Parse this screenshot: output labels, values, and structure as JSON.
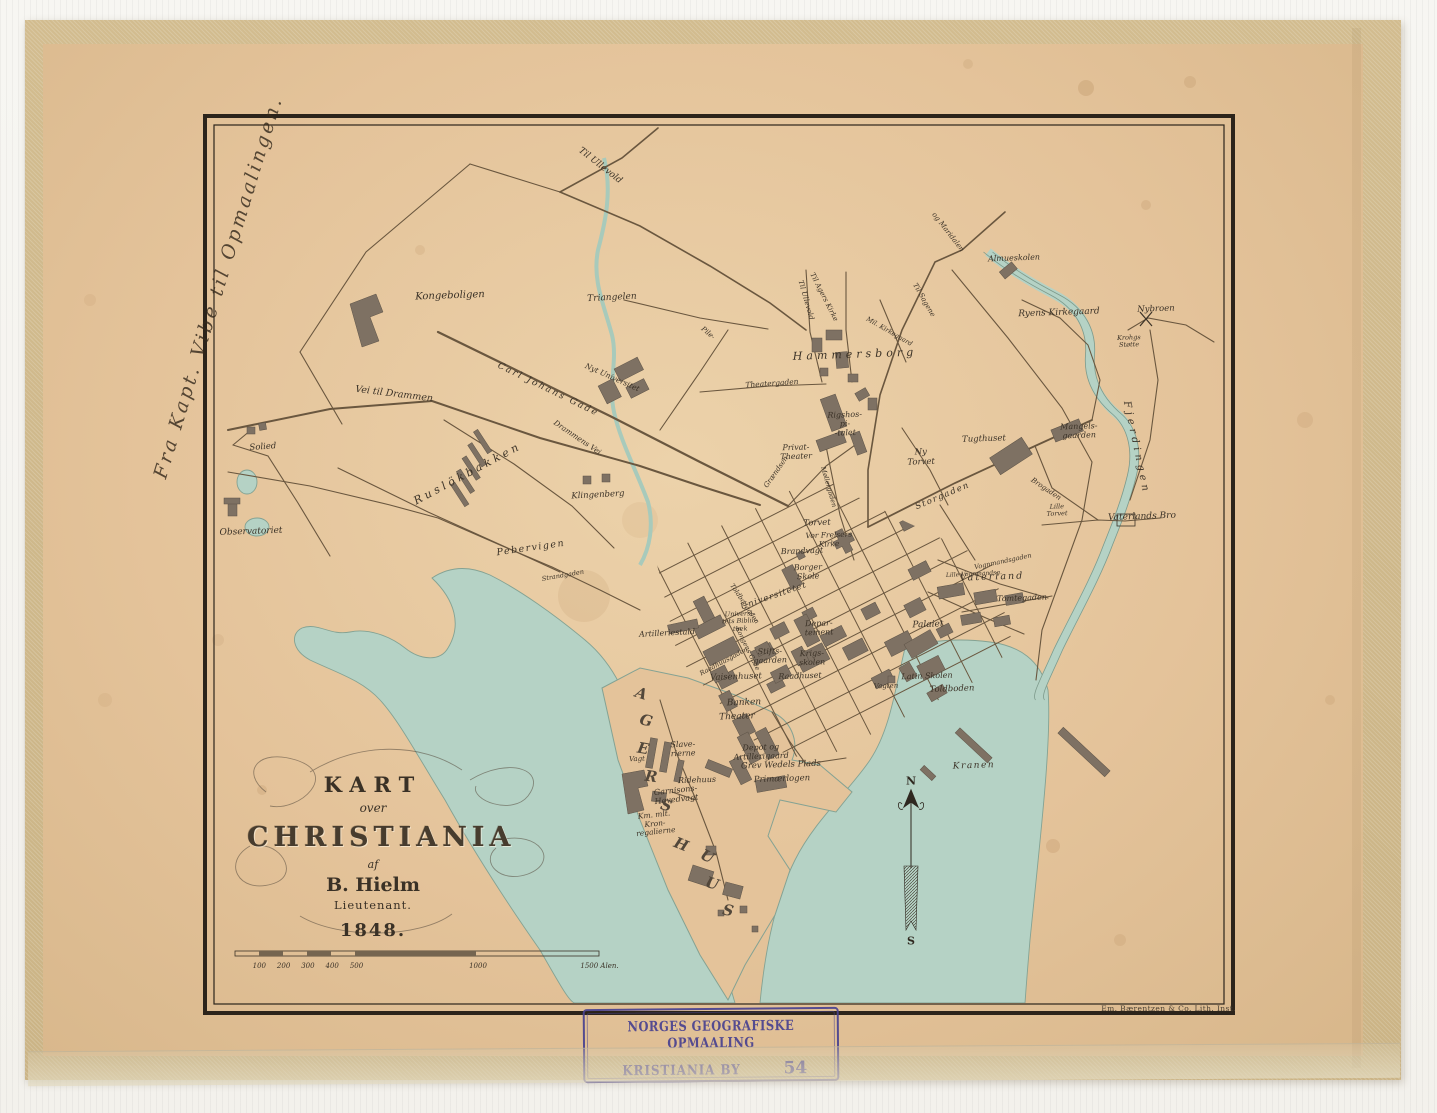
{
  "map": {
    "title_block": {
      "l1": "KART",
      "l2": "over",
      "l3": "CHRISTIANIA",
      "l4": "af",
      "l5": "B. Hielm",
      "l6": "Lieutenant.",
      "l7": "1848."
    },
    "compass": {
      "north": "N",
      "south": "S"
    },
    "scale_bar": {
      "ticks": [
        100,
        200,
        300,
        400,
        500,
        1000,
        1500
      ],
      "unit": "Alen."
    },
    "imprint": "Em. Bærentzen & Co. Lith. Inst.",
    "handwritten_note": "Fra Kapt. Vibe til Opmaalingen.",
    "labels": [
      {
        "t": "Til Ullevold",
        "x": 600,
        "y": 166,
        "r": 38,
        "s": 9
      },
      {
        "t": "Kongeboligen",
        "x": 450,
        "y": 296,
        "r": -2,
        "s": 10
      },
      {
        "t": "Triangelen",
        "x": 612,
        "y": 298,
        "r": -3,
        "s": 9
      },
      {
        "t": "Vei til Drammen",
        "x": 394,
        "y": 395,
        "r": 7,
        "s": 9.5
      },
      {
        "t": "Carl Johans Gade",
        "x": 548,
        "y": 390,
        "r": 26,
        "s": 9,
        "ls": 2
      },
      {
        "t": "Nyt Universitet",
        "x": 612,
        "y": 378,
        "r": 24,
        "s": 7.5
      },
      {
        "t": "Solied",
        "x": 263,
        "y": 448,
        "r": -4,
        "s": 8.5
      },
      {
        "t": "Observatoriet",
        "x": 251,
        "y": 532,
        "r": -2,
        "s": 9
      },
      {
        "t": "Ruslökbakken",
        "x": 468,
        "y": 474,
        "r": -28,
        "s": 11,
        "ls": 3.5
      },
      {
        "t": "Klingenberg",
        "x": 598,
        "y": 496,
        "r": -3,
        "s": 8.5
      },
      {
        "t": "Pebervigen",
        "x": 531,
        "y": 549,
        "r": -8,
        "s": 9.5,
        "ls": 1.5
      },
      {
        "t": "Strandgaden",
        "x": 563,
        "y": 576,
        "r": -10,
        "s": 6.5
      },
      {
        "t": "Drammens Vei",
        "x": 577,
        "y": 438,
        "r": 34,
        "s": 7.5
      },
      {
        "t": "Til Agers Kirke",
        "x": 824,
        "y": 297,
        "r": 63,
        "s": 7
      },
      {
        "t": "Til Ullevold",
        "x": 806,
        "y": 300,
        "r": 74,
        "s": 7
      },
      {
        "t": "Til Sagene",
        "x": 924,
        "y": 300,
        "r": 60,
        "s": 7
      },
      {
        "t": "og Maridalen",
        "x": 948,
        "y": 232,
        "r": 52,
        "s": 7
      },
      {
        "t": "Hammersborg",
        "x": 855,
        "y": 355,
        "r": -2,
        "s": 11,
        "ls": 4
      },
      {
        "t": "Mil. Kirkegaard",
        "x": 889,
        "y": 332,
        "r": 30,
        "s": 6.5
      },
      {
        "t": "Almueskolen",
        "x": 1014,
        "y": 258,
        "r": -2,
        "s": 8
      },
      {
        "t": "Ryens Kirkegaard",
        "x": 1059,
        "y": 313,
        "r": -2,
        "s": 9
      },
      {
        "t": "Nybroen",
        "x": 1156,
        "y": 310,
        "r": -2,
        "s": 8.5
      },
      {
        "t": "Krohgs\nStøtte",
        "x": 1129,
        "y": 342,
        "r": -2,
        "s": 6.5
      },
      {
        "t": "Mangels-\ngaarden",
        "x": 1079,
        "y": 431,
        "r": -2,
        "s": 8
      },
      {
        "t": "Tugthuset",
        "x": 984,
        "y": 440,
        "r": -2,
        "s": 8.5
      },
      {
        "t": "Ny\nTorvet",
        "x": 921,
        "y": 458,
        "r": -2,
        "s": 8.5
      },
      {
        "t": "Rigshos-\npi-\n-talet",
        "x": 845,
        "y": 424,
        "r": -2,
        "s": 8
      },
      {
        "t": "Privat-\nTheater",
        "x": 796,
        "y": 452,
        "r": -2,
        "s": 8
      },
      {
        "t": "Theatergaden",
        "x": 772,
        "y": 384,
        "r": -4,
        "s": 7.5
      },
      {
        "t": "Storgaden",
        "x": 943,
        "y": 497,
        "r": -23,
        "s": 8.5,
        "ls": 1.5
      },
      {
        "t": "Fjerdingen",
        "x": 1136,
        "y": 448,
        "r": 78,
        "s": 10,
        "ls": 4
      },
      {
        "t": "Vaterlands Bro",
        "x": 1142,
        "y": 517,
        "r": -2,
        "s": 9
      },
      {
        "t": "Lille\nTorvet",
        "x": 1057,
        "y": 511,
        "r": -2,
        "s": 6.5
      },
      {
        "t": "Vaterland",
        "x": 992,
        "y": 578,
        "r": -2,
        "s": 9.5,
        "ls": 2
      },
      {
        "t": "Tomtegaden",
        "x": 1022,
        "y": 598,
        "r": -2,
        "s": 8
      },
      {
        "t": "Vognmandsgaden",
        "x": 1003,
        "y": 562,
        "r": -12,
        "s": 6.5
      },
      {
        "t": "Lille Vognmandsg.",
        "x": 974,
        "y": 575,
        "r": -3,
        "s": 6
      },
      {
        "t": "Torvet",
        "x": 817,
        "y": 524,
        "r": -2,
        "s": 8.5
      },
      {
        "t": "Vor Frelsers\nKirke",
        "x": 829,
        "y": 540,
        "r": -2,
        "s": 7.5
      },
      {
        "t": "Brandvagt",
        "x": 802,
        "y": 551,
        "r": -2,
        "s": 8
      },
      {
        "t": "Borger\nSkole",
        "x": 808,
        "y": 572,
        "r": -2,
        "s": 8
      },
      {
        "t": "Universitetet",
        "x": 774,
        "y": 597,
        "r": -19,
        "s": 8.5,
        "ls": 1
      },
      {
        "t": "Universi-\ntets Biblio-\nthek",
        "x": 740,
        "y": 622,
        "r": -2,
        "s": 6.5
      },
      {
        "t": "Artilleriestald",
        "x": 667,
        "y": 633,
        "r": -3,
        "s": 8
      },
      {
        "t": "Depar-\ntement",
        "x": 819,
        "y": 628,
        "r": -2,
        "s": 8
      },
      {
        "t": "Stifts-\ngaarden",
        "x": 770,
        "y": 656,
        "r": -2,
        "s": 8
      },
      {
        "t": "Krigs-\nskolen",
        "x": 812,
        "y": 658,
        "r": -2,
        "s": 8
      },
      {
        "t": "Raadhuset",
        "x": 800,
        "y": 676,
        "r": -2,
        "s": 8
      },
      {
        "t": "Vaisenhuset",
        "x": 736,
        "y": 678,
        "r": -2,
        "s": 8.5
      },
      {
        "t": "Palaiet",
        "x": 928,
        "y": 625,
        "r": -2,
        "s": 9
      },
      {
        "t": "Latin Skolen",
        "x": 927,
        "y": 676,
        "r": -2,
        "s": 8
      },
      {
        "t": "Toldboden",
        "x": 952,
        "y": 690,
        "r": -2,
        "s": 8.5
      },
      {
        "t": "Vagten",
        "x": 886,
        "y": 686,
        "r": -2,
        "s": 7
      },
      {
        "t": "Banken",
        "x": 744,
        "y": 703,
        "r": -2,
        "s": 9
      },
      {
        "t": "Theater",
        "x": 737,
        "y": 717,
        "r": -2,
        "s": 9
      },
      {
        "t": "Slave-\nrierne",
        "x": 683,
        "y": 749,
        "r": -2,
        "s": 8
      },
      {
        "t": "Vagt",
        "x": 637,
        "y": 759,
        "r": -2,
        "s": 7
      },
      {
        "t": "Depot og\nArtillerigaard",
        "x": 761,
        "y": 752,
        "r": -2,
        "s": 8
      },
      {
        "t": "Grev Wedels Plads",
        "x": 781,
        "y": 766,
        "r": -2,
        "s": 8.5
      },
      {
        "t": "Primærlogen",
        "x": 782,
        "y": 780,
        "r": -2,
        "s": 8.5
      },
      {
        "t": "Ridehuus",
        "x": 697,
        "y": 780,
        "r": -2,
        "s": 8
      },
      {
        "t": "Garnisons-\nHovedvagt",
        "x": 676,
        "y": 795,
        "r": -6,
        "s": 8
      },
      {
        "t": "Km. mlt.\nKron-\nregalierne",
        "x": 655,
        "y": 824,
        "r": -6,
        "s": 7.5
      },
      {
        "t": "Kranen",
        "x": 974,
        "y": 766,
        "r": -2,
        "s": 9,
        "ls": 1.5
      },
      {
        "t": "Grændsen",
        "x": 776,
        "y": 472,
        "r": -55,
        "s": 7
      },
      {
        "t": "Møllergaden",
        "x": 828,
        "y": 487,
        "r": 74,
        "s": 6.5
      },
      {
        "t": "Pile-",
        "x": 708,
        "y": 333,
        "r": 40,
        "s": 7
      },
      {
        "t": "Kongens Gade",
        "x": 747,
        "y": 649,
        "r": 64,
        "s": 6.5
      },
      {
        "t": "Toldbodgaden",
        "x": 744,
        "y": 604,
        "r": 56,
        "s": 6.5
      },
      {
        "t": "Raadhuusgaden",
        "x": 724,
        "y": 662,
        "r": -28,
        "s": 6.5
      },
      {
        "t": "Brogaden",
        "x": 1046,
        "y": 489,
        "r": 34,
        "s": 7
      },
      {
        "t": "A",
        "x": 641,
        "y": 694,
        "r": 18,
        "s": 15,
        "c": "big"
      },
      {
        "t": "G",
        "x": 646,
        "y": 721,
        "r": 14,
        "s": 15,
        "c": "big"
      },
      {
        "t": "E",
        "x": 643,
        "y": 749,
        "r": 10,
        "s": 15,
        "c": "big"
      },
      {
        "t": "R",
        "x": 651,
        "y": 777,
        "r": 8,
        "s": 15,
        "c": "big"
      },
      {
        "t": "S",
        "x": 666,
        "y": 806,
        "r": 16,
        "s": 15,
        "c": "big"
      },
      {
        "t": "H",
        "x": 681,
        "y": 845,
        "r": 22,
        "s": 15,
        "c": "big"
      },
      {
        "t": "U",
        "x": 707,
        "y": 857,
        "r": 26,
        "s": 15,
        "c": "big"
      },
      {
        "t": "U",
        "x": 712,
        "y": 884,
        "r": 18,
        "s": 15,
        "c": "big"
      },
      {
        "t": "S",
        "x": 728,
        "y": 911,
        "r": 12,
        "s": 15,
        "c": "big"
      }
    ]
  },
  "stamp": {
    "line1": "NORGES GEOGRAFISKE OPMAALING",
    "line2": "KRISTIANIA BY",
    "number": "54"
  },
  "colors": {
    "paper": "#e4c39a",
    "water": "#b5d2c5",
    "ink": "#3b3227",
    "building": "#7e7163",
    "stamp": "#4a4390"
  }
}
